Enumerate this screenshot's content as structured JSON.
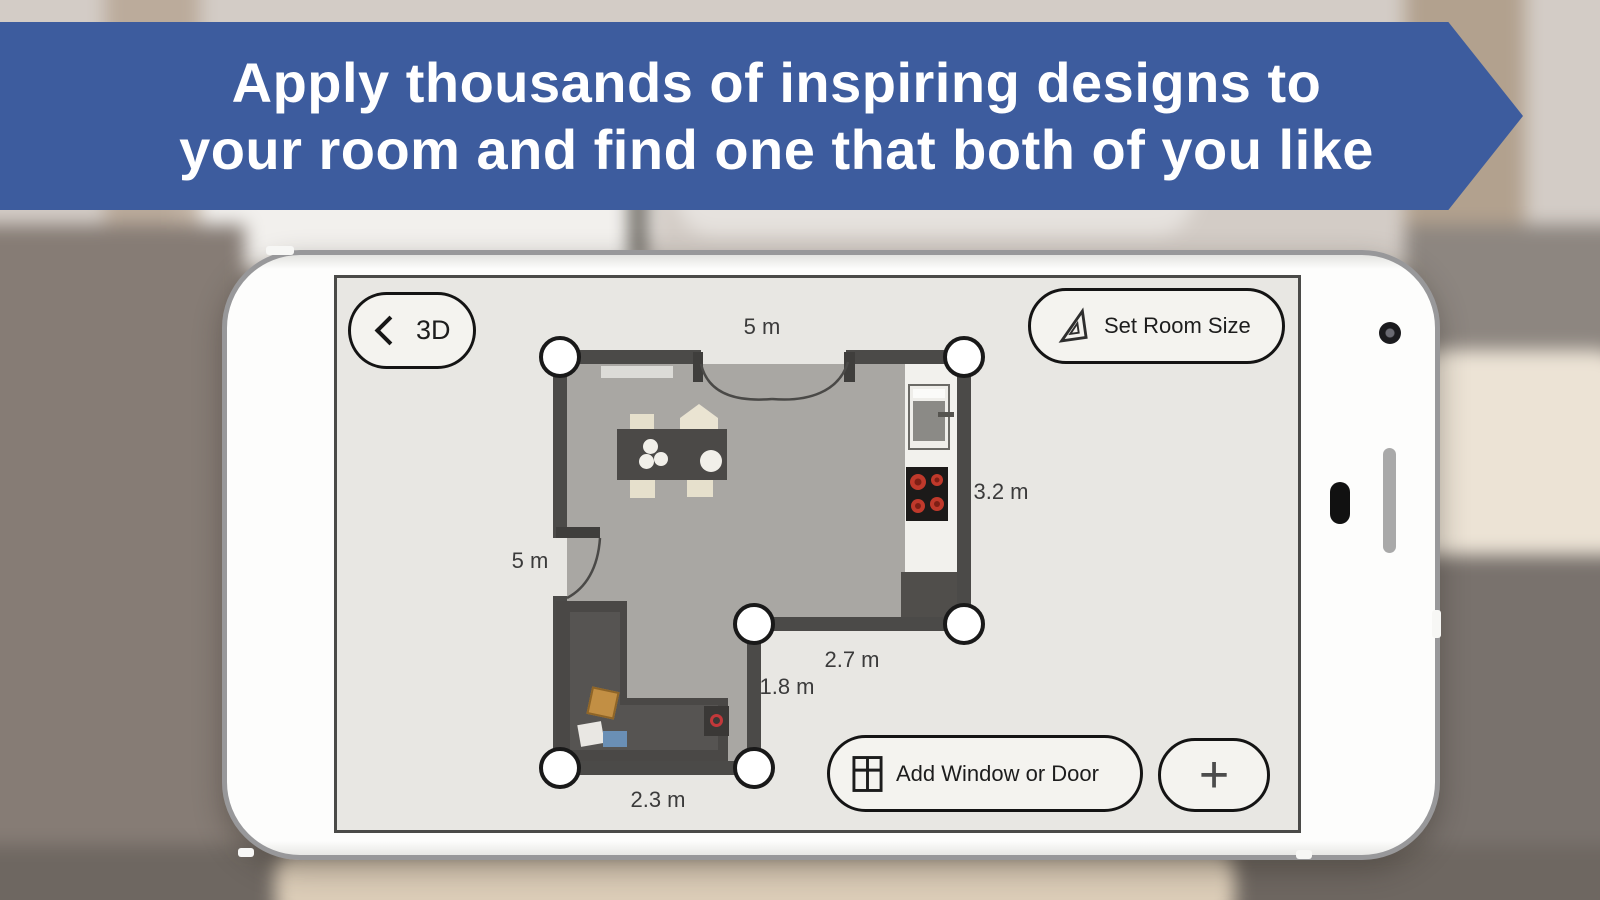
{
  "banner": {
    "line1": "Apply thousands of inspiring designs to",
    "line2": "your room and find one that both of you like",
    "bg_color": "#3d5c9e",
    "text_color": "#ffffff"
  },
  "toolbar": {
    "back_label": "3D",
    "set_room_size_label": "Set Room Size",
    "add_window_door_label": "Add Window or Door",
    "plus_label": "+"
  },
  "floorplan": {
    "dims": {
      "top": "5 m",
      "left": "5 m",
      "right": "3.2 m",
      "inner_h": "2.7 m",
      "inner_v": "1.8 m",
      "bottom": "2.3 m"
    },
    "corner_handle_count": 6
  },
  "icons": {
    "back": "chevron-left",
    "set_room_size": "set-square-ruler",
    "add_window_door": "window-grid",
    "add": "plus"
  },
  "colors": {
    "banner_blue": "#3d5c9e",
    "wall": "#4b4a48",
    "room_floor": "#a9a7a3",
    "screen_bg": "#e8e7e3",
    "burner_red": "#c0392b",
    "handle_ring": "#191919",
    "pillow_orange": "#c28f44",
    "pillow_blue": "#6a8fb5"
  }
}
